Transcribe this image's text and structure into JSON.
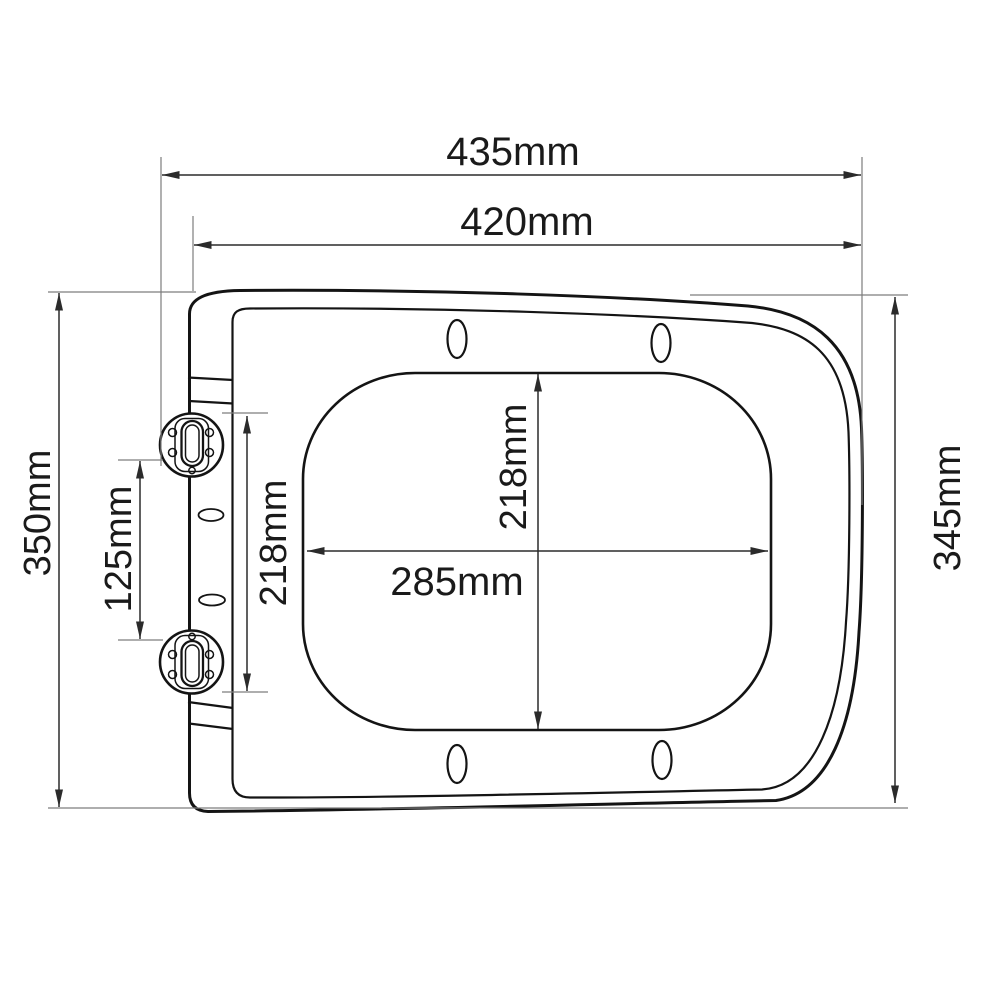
{
  "drawing": {
    "type": "technical-dimension-diagram",
    "subject": "toilet seat top view with hinges",
    "colors": {
      "background": "#ffffff",
      "outline": "#141414",
      "dimension_line": "#2b2b2b",
      "extension_line": "#7d7d7d",
      "label_text": "#1a1a1a"
    },
    "dimensions": {
      "width_overall": "435mm",
      "width_seat": "420mm",
      "height_left": "350mm",
      "hinge_spacing": "125mm",
      "hinge_span": "218mm",
      "opening_length": "218mm",
      "opening_width": "285mm",
      "height_right": "345mm"
    }
  }
}
